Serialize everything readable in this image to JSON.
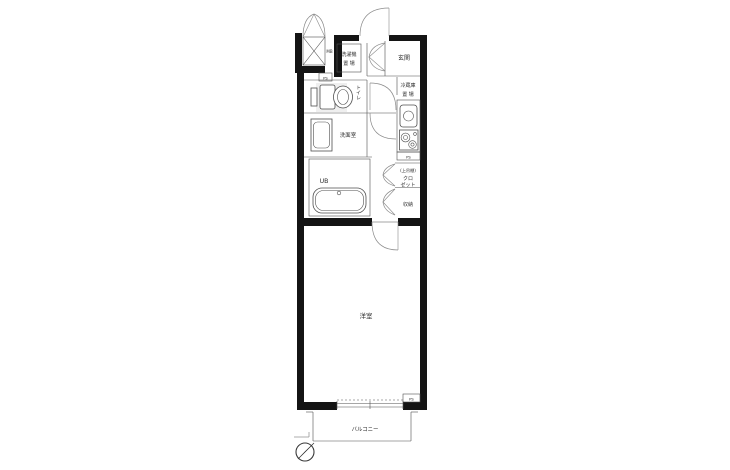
{
  "labels": {
    "meter_box": "MB",
    "ps": "PS",
    "washing_machine_line1": "洗濯機",
    "washing_machine_line2": "置 場",
    "entrance": "玄関",
    "toilet": "トイレ",
    "fridge_line1": "冷蔵庫",
    "fridge_line2": "置 場",
    "washroom": "洗面室",
    "unit_bath": "UB",
    "closet_shelf": "(上吊棚)",
    "closet_line1": "クロ",
    "closet_line2": "ゼット",
    "storage": "収納",
    "western_room": "洋室",
    "balcony": "バルコニー"
  },
  "colors": {
    "wall": "#141414",
    "line": "#4f4f4f",
    "thin": "#8a8a8a",
    "text": "#2e2e2e",
    "bg": "#ffffff"
  }
}
